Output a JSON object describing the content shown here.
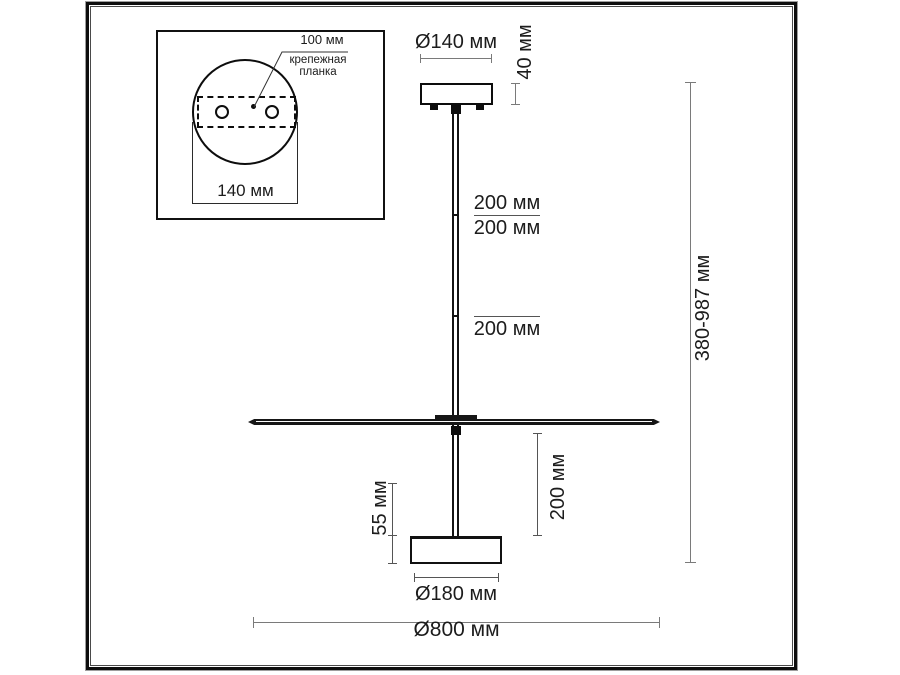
{
  "figure": {
    "type": "technical-drawing",
    "subject": "ceiling pendant light fixture with mounting plate detail",
    "units": "мм"
  },
  "inset": {
    "hole_spacing_label": "100 мм",
    "bracket_label_line1": "крепежная",
    "bracket_label_line2": "планка",
    "plate_width_label": "140 мм"
  },
  "dims": {
    "canopy_diameter": "Ø140 мм",
    "canopy_height": "40 мм",
    "rod_segments": [
      "200 мм",
      "200 мм",
      "200 мм"
    ],
    "head_drop": "200 мм",
    "head_height": "55 мм",
    "head_diameter": "Ø180 мм",
    "disc_diameter": "Ø800 мм",
    "overall_height": "380-987 мм"
  },
  "colors": {
    "structure_line": "#111111",
    "dimension_line": "#7a7a7a",
    "text": "#1c1c1c",
    "background": "#ffffff"
  }
}
